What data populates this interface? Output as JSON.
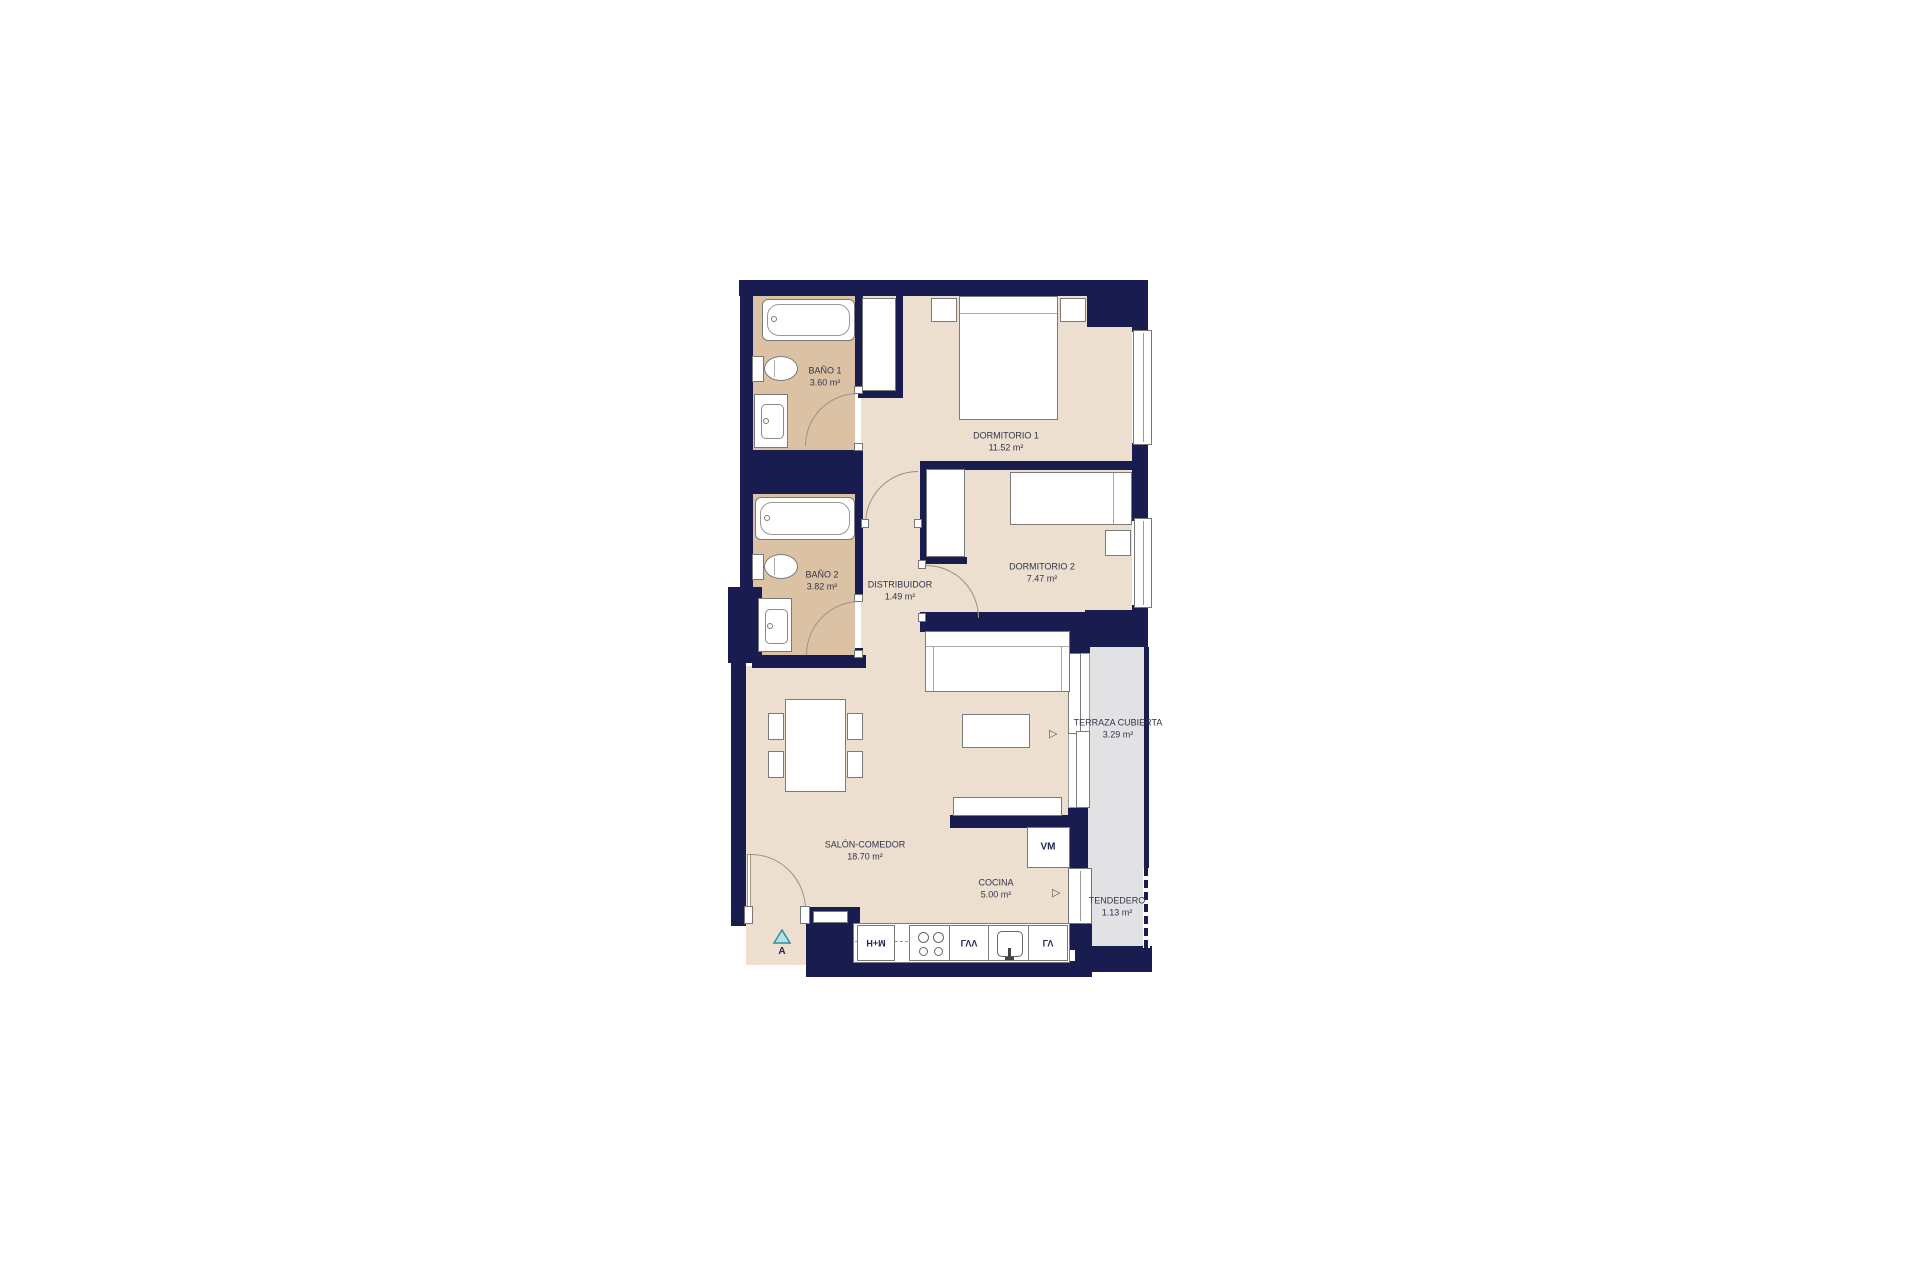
{
  "rooms": {
    "bano1": {
      "name": "BAÑO 1",
      "area": "3.60 m²"
    },
    "dormitorio1": {
      "name": "DORMITORIO 1",
      "area": "11.52 m²"
    },
    "bano2": {
      "name": "BAÑO 2",
      "area": "3.82 m²"
    },
    "distribuidor": {
      "name": "DISTRIBUIDOR",
      "area": "1.49 m²"
    },
    "dormitorio2": {
      "name": "DORMITORIO 2",
      "area": "7.47 m²"
    },
    "salon": {
      "name": "SALÓN-COMEDOR",
      "area": "18.70 m²"
    },
    "cocina": {
      "name": "COCINA",
      "area": "5.00 m²"
    },
    "terraza": {
      "name": "TERRAZA CUBIERTA",
      "area": "3.29 m²"
    },
    "tendedero": {
      "name": "TENDEDERO",
      "area": "1.13 m²"
    }
  },
  "kitchen": {
    "oven_micro": "H+M",
    "dishwasher": "LVV",
    "washer": "LV",
    "appliance_box": "VM"
  },
  "entrance": {
    "marker": "A"
  },
  "colors": {
    "wall": "#191c4f",
    "wet_room_floor": "#dcc2a5",
    "living_floor": "#ecdfd0",
    "terrace_floor": "#e2e2e5",
    "entry_triangle_fill": "#b5e3e4",
    "entry_triangle_stroke": "#2e8f9e"
  }
}
